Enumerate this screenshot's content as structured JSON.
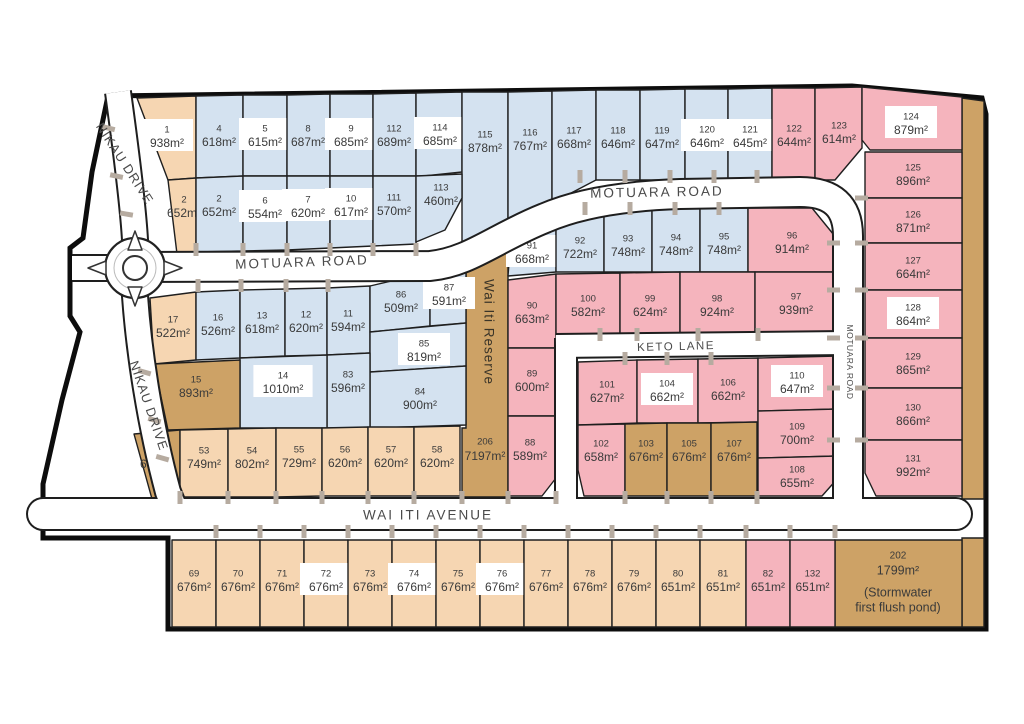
{
  "colors": {
    "lot_blue": "#d4e2f0",
    "lot_peach": "#f6d6b2",
    "lot_tan": "#cda266",
    "lot_pink": "#f5b4bd",
    "road_fill": "#ffffff",
    "road_casing": "#1e1e1e",
    "boundary": "#0d0d0d",
    "label_box": "#ffffff",
    "lot_text": "#3a3a3a",
    "road_text": "#4a4a4a",
    "driveway_tick": "#b6aba0"
  },
  "roads": {
    "nikau-upper": "NIKAU DRIVE",
    "nikau-lower": "NIKAU DRIVE",
    "motuara-west": "MOTUARA ROAD",
    "motuara-north": "MOTUARA ROAD",
    "motuara-east": "MOTUARA ROAD",
    "keto-lane": "KETO LANE",
    "wai-iti-avenue": "WAI ITI AVENUE"
  },
  "reserve": {
    "number": "206",
    "area": "7197m²",
    "name": "Wai Iti Reserve"
  },
  "stormwater_lot": {
    "number": "202",
    "area": "1799m²",
    "note_line1": "(Stormwater",
    "note_line2": "first flush pond)"
  },
  "lots": [
    {
      "key": "1",
      "number": "1",
      "area": "938m²",
      "color": "lot_peach",
      "highlighted": true
    },
    {
      "key": "4",
      "number": "4",
      "area": "618m²",
      "color": "lot_blue",
      "highlighted": false
    },
    {
      "key": "5",
      "number": "5",
      "area": "615m²",
      "color": "lot_blue",
      "highlighted": true
    },
    {
      "key": "8",
      "number": "8",
      "area": "687m²",
      "color": "lot_blue",
      "highlighted": false
    },
    {
      "key": "9",
      "number": "9",
      "area": "685m²",
      "color": "lot_blue",
      "highlighted": true
    },
    {
      "key": "112",
      "number": "112",
      "area": "689m²",
      "color": "lot_blue",
      "highlighted": false
    },
    {
      "key": "114",
      "number": "114",
      "area": "685m²",
      "color": "lot_blue",
      "highlighted": true
    },
    {
      "key": "115",
      "number": "115",
      "area": "878m²",
      "color": "lot_blue",
      "highlighted": false
    },
    {
      "key": "116",
      "number": "116",
      "area": "767m²",
      "color": "lot_blue",
      "highlighted": false
    },
    {
      "key": "117",
      "number": "117",
      "area": "668m²",
      "color": "lot_blue",
      "highlighted": false
    },
    {
      "key": "118",
      "number": "118",
      "area": "646m²",
      "color": "lot_blue",
      "highlighted": false
    },
    {
      "key": "119",
      "number": "119",
      "area": "647m²",
      "color": "lot_blue",
      "highlighted": false
    },
    {
      "key": "120",
      "number": "120",
      "area": "646m²",
      "color": "lot_blue",
      "highlighted": true
    },
    {
      "key": "121",
      "number": "121",
      "area": "645m²",
      "color": "lot_blue",
      "highlighted": true
    },
    {
      "key": "122",
      "number": "122",
      "area": "644m²",
      "color": "lot_pink",
      "highlighted": false
    },
    {
      "key": "123",
      "number": "123",
      "area": "614m²",
      "color": "lot_pink",
      "highlighted": false
    },
    {
      "key": "124",
      "number": "124",
      "area": "879m²",
      "color": "lot_pink",
      "highlighted": true
    },
    {
      "key": "2-west",
      "number": "2",
      "area": "652m²",
      "color": "lot_peach",
      "highlighted": false
    },
    {
      "key": "2-east",
      "number": "2",
      "area": "652m²",
      "color": "lot_blue",
      "highlighted": false
    },
    {
      "key": "6",
      "number": "6",
      "area": "554m²",
      "color": "lot_blue",
      "highlighted": true
    },
    {
      "key": "7",
      "number": "7",
      "area": "620m²",
      "color": "lot_blue",
      "highlighted": true
    },
    {
      "key": "10",
      "number": "10",
      "area": "617m²",
      "color": "lot_blue",
      "highlighted": true
    },
    {
      "key": "111",
      "number": "111",
      "area": "570m²",
      "color": "lot_blue",
      "highlighted": false
    },
    {
      "key": "113",
      "number": "113",
      "area": "460m²",
      "color": "lot_blue",
      "highlighted": false
    },
    {
      "key": "125",
      "number": "125",
      "area": "896m²",
      "color": "lot_pink",
      "highlighted": false
    },
    {
      "key": "126",
      "number": "126",
      "area": "871m²",
      "color": "lot_pink",
      "highlighted": false
    },
    {
      "key": "127",
      "number": "127",
      "area": "664m²",
      "color": "lot_pink",
      "highlighted": false
    },
    {
      "key": "128",
      "number": "128",
      "area": "864m²",
      "color": "lot_pink",
      "highlighted": true
    },
    {
      "key": "129",
      "number": "129",
      "area": "865m²",
      "color": "lot_pink",
      "highlighted": false
    },
    {
      "key": "130",
      "number": "130",
      "area": "866m²",
      "color": "lot_pink",
      "highlighted": false
    },
    {
      "key": "131",
      "number": "131",
      "area": "992m²",
      "color": "lot_pink",
      "highlighted": false
    },
    {
      "key": "91",
      "number": "91",
      "area": "668m²",
      "color": "lot_blue",
      "highlighted": true
    },
    {
      "key": "92",
      "number": "92",
      "area": "722m²",
      "color": "lot_blue",
      "highlighted": false
    },
    {
      "key": "93",
      "number": "93",
      "area": "748m²",
      "color": "lot_blue",
      "highlighted": false
    },
    {
      "key": "94",
      "number": "94",
      "area": "748m²",
      "color": "lot_blue",
      "highlighted": false
    },
    {
      "key": "95",
      "number": "95",
      "area": "748m²",
      "color": "lot_blue",
      "highlighted": false
    },
    {
      "key": "96",
      "number": "96",
      "area": "914m²",
      "color": "lot_pink",
      "highlighted": false
    },
    {
      "key": "90",
      "number": "90",
      "area": "663m²",
      "color": "lot_pink",
      "highlighted": false
    },
    {
      "key": "100",
      "number": "100",
      "area": "582m²",
      "color": "lot_pink",
      "highlighted": false
    },
    {
      "key": "99",
      "number": "99",
      "area": "624m²",
      "color": "lot_pink",
      "highlighted": false
    },
    {
      "key": "98",
      "number": "98",
      "area": "924m²",
      "color": "lot_pink",
      "highlighted": false
    },
    {
      "key": "97",
      "number": "97",
      "area": "939m²",
      "color": "lot_pink",
      "highlighted": false
    },
    {
      "key": "17",
      "number": "17",
      "area": "522m²",
      "color": "lot_peach",
      "highlighted": false
    },
    {
      "key": "16",
      "number": "16",
      "area": "526m²",
      "color": "lot_blue",
      "highlighted": false
    },
    {
      "key": "13",
      "number": "13",
      "area": "618m²",
      "color": "lot_blue",
      "highlighted": false
    },
    {
      "key": "12",
      "number": "12",
      "area": "620m²",
      "color": "lot_blue",
      "highlighted": false
    },
    {
      "key": "11",
      "number": "11",
      "area": "594m²",
      "color": "lot_blue",
      "highlighted": false
    },
    {
      "key": "86",
      "number": "86",
      "area": "509m²",
      "color": "lot_blue",
      "highlighted": false
    },
    {
      "key": "87",
      "number": "87",
      "area": "591m²",
      "color": "lot_blue",
      "highlighted": true
    },
    {
      "key": "85",
      "number": "85",
      "area": "819m²",
      "color": "lot_blue",
      "highlighted": true
    },
    {
      "key": "84",
      "number": "84",
      "area": "900m²",
      "color": "lot_blue",
      "highlighted": false
    },
    {
      "key": "83",
      "number": "83",
      "area": "596m²",
      "color": "lot_blue",
      "highlighted": false
    },
    {
      "key": "14",
      "number": "14",
      "area": "1010m²",
      "color": "lot_blue",
      "highlighted": true
    },
    {
      "key": "15",
      "number": "15",
      "area": "893m²",
      "color": "lot_tan",
      "highlighted": false
    },
    {
      "key": "52",
      "number": "52",
      "area": "668m²",
      "color": "lot_tan",
      "highlighted": false
    },
    {
      "key": "53",
      "number": "53",
      "area": "749m²",
      "color": "lot_peach",
      "highlighted": false
    },
    {
      "key": "54",
      "number": "54",
      "area": "802m²",
      "color": "lot_peach",
      "highlighted": false
    },
    {
      "key": "55",
      "number": "55",
      "area": "729m²",
      "color": "lot_peach",
      "highlighted": false
    },
    {
      "key": "56",
      "number": "56",
      "area": "620m²",
      "color": "lot_peach",
      "highlighted": false
    },
    {
      "key": "57",
      "number": "57",
      "area": "620m²",
      "color": "lot_peach",
      "highlighted": false
    },
    {
      "key": "58",
      "number": "58",
      "area": "620m²",
      "color": "lot_peach",
      "highlighted": false
    },
    {
      "key": "89",
      "number": "89",
      "area": "600m²",
      "color": "lot_pink",
      "highlighted": false
    },
    {
      "key": "88",
      "number": "88",
      "area": "589m²",
      "color": "lot_pink",
      "highlighted": false
    },
    {
      "key": "101",
      "number": "101",
      "area": "627m²",
      "color": "lot_pink",
      "highlighted": false
    },
    {
      "key": "104",
      "number": "104",
      "area": "662m²",
      "color": "lot_pink",
      "highlighted": true
    },
    {
      "key": "106",
      "number": "106",
      "area": "662m²",
      "color": "lot_pink",
      "highlighted": false
    },
    {
      "key": "110",
      "number": "110",
      "area": "647m²",
      "color": "lot_pink",
      "highlighted": true
    },
    {
      "key": "109",
      "number": "109",
      "area": "700m²",
      "color": "lot_pink",
      "highlighted": false
    },
    {
      "key": "108",
      "number": "108",
      "area": "655m²",
      "color": "lot_pink",
      "highlighted": false
    },
    {
      "key": "102",
      "number": "102",
      "area": "658m²",
      "color": "lot_pink",
      "highlighted": false
    },
    {
      "key": "103",
      "number": "103",
      "area": "676m²",
      "color": "lot_tan",
      "highlighted": false
    },
    {
      "key": "105",
      "number": "105",
      "area": "676m²",
      "color": "lot_tan",
      "highlighted": false
    },
    {
      "key": "107",
      "number": "107",
      "area": "676m²",
      "color": "lot_tan",
      "highlighted": false
    },
    {
      "key": "69",
      "number": "69",
      "area": "676m²",
      "color": "lot_peach",
      "highlighted": false
    },
    {
      "key": "70",
      "number": "70",
      "area": "676m²",
      "color": "lot_peach",
      "highlighted": false
    },
    {
      "key": "71",
      "number": "71",
      "area": "676m²",
      "color": "lot_peach",
      "highlighted": false
    },
    {
      "key": "72",
      "number": "72",
      "area": "676m²",
      "color": "lot_peach",
      "highlighted": true
    },
    {
      "key": "73",
      "number": "73",
      "area": "676m²",
      "color": "lot_peach",
      "highlighted": false
    },
    {
      "key": "74",
      "number": "74",
      "area": "676m²",
      "color": "lot_peach",
      "highlighted": true
    },
    {
      "key": "75",
      "number": "75",
      "area": "676m²",
      "color": "lot_peach",
      "highlighted": false
    },
    {
      "key": "76",
      "number": "76",
      "area": "676m²",
      "color": "lot_peach",
      "highlighted": true
    },
    {
      "key": "77",
      "number": "77",
      "area": "676m²",
      "color": "lot_peach",
      "highlighted": false
    },
    {
      "key": "78",
      "number": "78",
      "area": "676m²",
      "color": "lot_peach",
      "highlighted": false
    },
    {
      "key": "79",
      "number": "79",
      "area": "676m²",
      "color": "lot_peach",
      "highlighted": false
    },
    {
      "key": "80",
      "number": "80",
      "area": "651m²",
      "color": "lot_peach",
      "highlighted": false
    },
    {
      "key": "81",
      "number": "81",
      "area": "651m²",
      "color": "lot_peach",
      "highlighted": false
    },
    {
      "key": "82",
      "number": "82",
      "area": "651m²",
      "color": "lot_pink",
      "highlighted": false
    },
    {
      "key": "132",
      "number": "132",
      "area": "651m²",
      "color": "lot_pink",
      "highlighted": false
    }
  ]
}
